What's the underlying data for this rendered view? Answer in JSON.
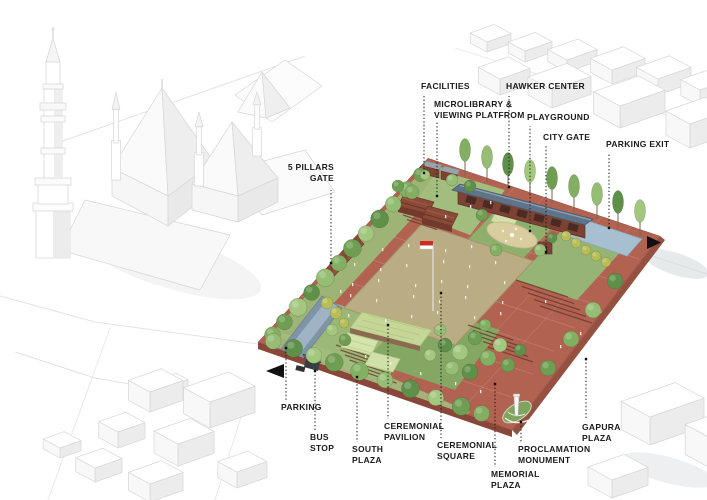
{
  "diagram_type": "axonometric-site-plan",
  "labels": {
    "facilities": [
      "FACILITIES"
    ],
    "microlibrary": [
      "MICROLIBRARY &",
      "VIEWING PLATFROM"
    ],
    "hawker_center": [
      "HAWKER CENTER"
    ],
    "playground": [
      "PLAYGROUND"
    ],
    "city_gate": [
      "CITY GATE"
    ],
    "parking_exit": [
      "PARKING EXIT"
    ],
    "five_pillars_gate": [
      "5 PILLARS",
      "GATE"
    ],
    "parking": [
      "PARKING"
    ],
    "bus_stop": [
      "BUS",
      "STOP"
    ],
    "south_plaza": [
      "SOUTH",
      "PLAZA"
    ],
    "ceremonial_pavilion": [
      "CEREMONIAL",
      "PAVILION"
    ],
    "ceremonial_square": [
      "CEREMONIAL",
      "SQUARE"
    ],
    "memorial_plaza": [
      "MEMORIAL",
      "PLAZA"
    ],
    "proclamation_monument": [
      "PROCLAMATION",
      "MONUMENT"
    ],
    "gapura_plaza": [
      "GAPURA",
      "PLAZA"
    ]
  },
  "icons": {
    "east_arrow": "right-pointing-triangle-arrow",
    "west_arrow": "left-pointing-triangle-arrow"
  },
  "colors": {
    "background": "#ffffff",
    "paving": "#b26251",
    "central_square": "#b6a87d",
    "lawn": "#9cb878",
    "water": "#a6c0d2",
    "roof_blue": "#5f7489",
    "brick": "#7c4335",
    "flag_red": "#cf2b22",
    "label_text": "#1a1a1a"
  }
}
